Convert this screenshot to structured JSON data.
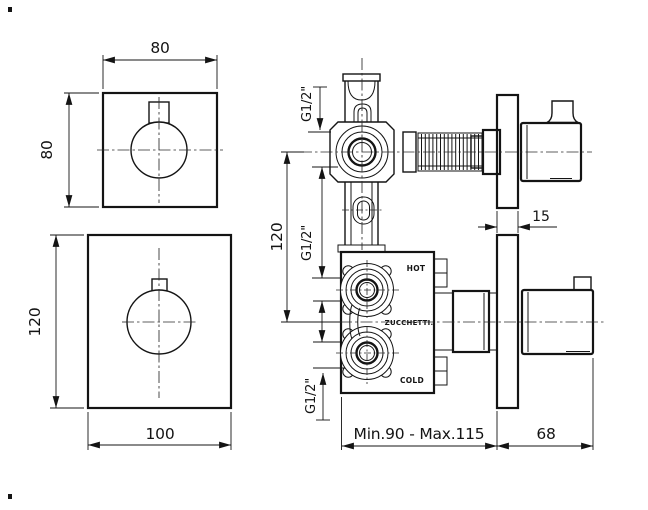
{
  "labels": {
    "hot": "HOT",
    "brand": "ZUCCHETTI.",
    "cold": "COLD"
  },
  "dimensions": {
    "small_plate_width": "80",
    "small_plate_height": "80",
    "large_plate_height": "120",
    "large_plate_width": "100",
    "outlet_offset": "120",
    "thread_top": "G1/2\"",
    "thread_middle": "G1/2\"",
    "thread_bottom": "G1/2\"",
    "plate_thickness": "15",
    "recess_depth": "Min.90 - Max.115",
    "handle_depth": "68"
  },
  "colors": {
    "line": "#141414",
    "background": "#ffffff"
  }
}
